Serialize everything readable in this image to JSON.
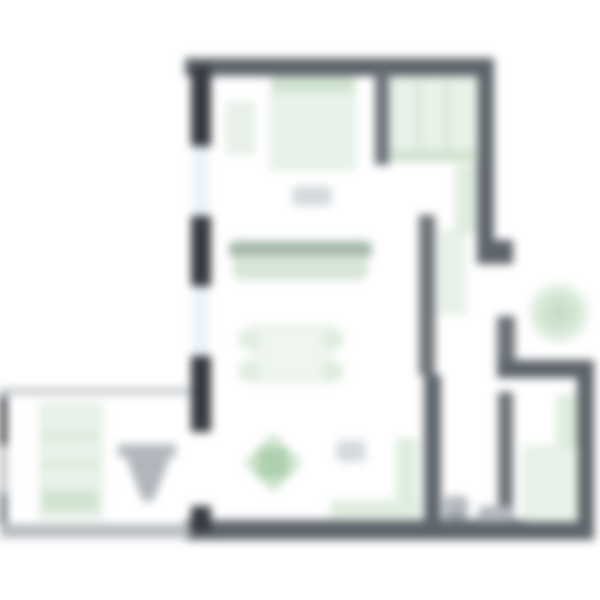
{
  "meta": {
    "kind": "architectural floor plan, top-down, heavily blurred render",
    "canvas": "600x600",
    "visible_text": "none legible (two small grey label smudges only)"
  },
  "palette": {
    "background": "#ffffff",
    "wall_main": "#5d646b",
    "wall_dark_piers": "#363a40",
    "wall_secondary": "#6a7177",
    "wall_annex_light": "#b7bcc0",
    "window_glass": "#e9f3f8",
    "window_frame": "#ccd9e1",
    "furniture_green_fill": "#e9f2e9",
    "furniture_green_border": "#c2d8c2",
    "sofa_back_green": "#a7b8ab",
    "plant_green": "#a8cca8",
    "fixture_grey": "#b3b9be",
    "label_smudge_grey": "#cfd3d7"
  },
  "rooms": {
    "bedroom": {
      "label": "bedroom area (top-left)",
      "furniture": [
        "double-bed",
        "nightstand"
      ]
    },
    "closet": {
      "label": "closet / wardrobe (top-right)",
      "furniture": [
        "wardrobe-shelving",
        "side-counter"
      ]
    },
    "living": {
      "label": "living-dining area (center)",
      "furniture": [
        "sofa",
        "dining-table",
        "4 chairs",
        "plant",
        "tall-cabinet",
        "low-sideboard"
      ]
    },
    "hallway": {
      "label": "hallway / entry (right-middle)",
      "furniture": [
        "hall-cabinet"
      ],
      "outside": [
        "entry-plant"
      ]
    },
    "bathroom": {
      "label": "bathroom / WC (bottom-center-right)",
      "furniture": [
        "toilet",
        "washbasin"
      ]
    },
    "storage": {
      "label": "small room (bottom-right)",
      "furniture": [
        "green-storage-unit",
        "wall-strip-unit"
      ]
    },
    "terrace": {
      "label": "annex / terrace (bottom-left)",
      "furniture": [
        "lounger-bed",
        "door-swing-symbol"
      ]
    }
  },
  "openings": {
    "windows_left_wall": 2,
    "door_to_terrace": "gap in left wall, lower third",
    "entry_gap_right_wall": "gap between upper right wall and notch wall"
  },
  "counts": {
    "chairs_at_table": 4,
    "label_smudges": 2
  }
}
